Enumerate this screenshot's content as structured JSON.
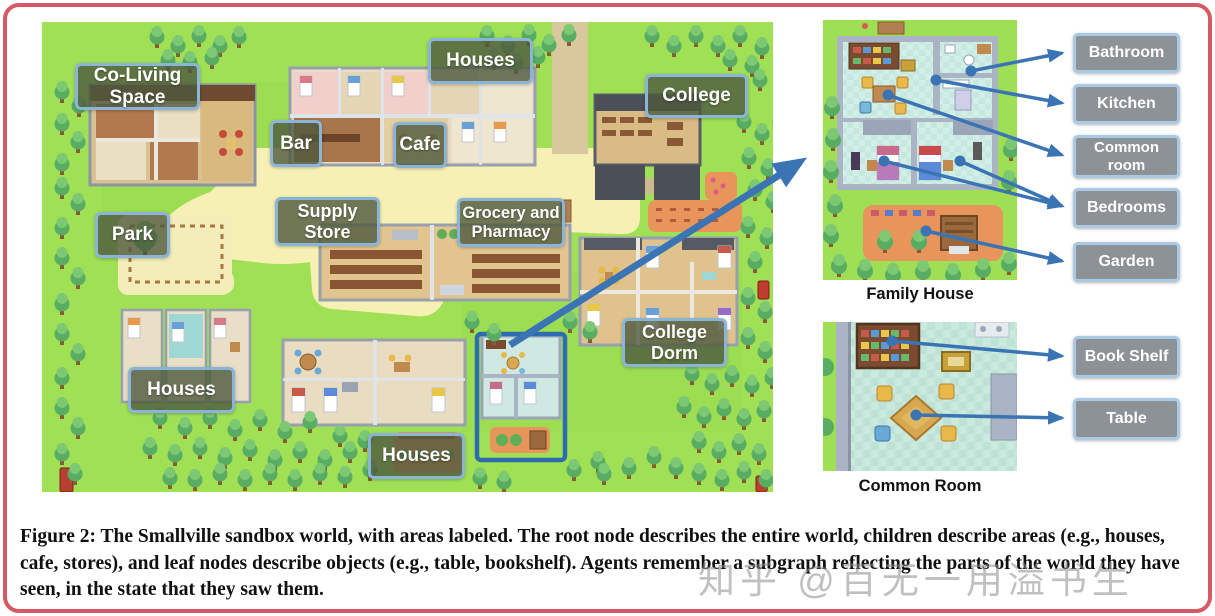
{
  "map": {
    "area_labels": [
      {
        "id": "co-living-space",
        "text": "Co-Living Space"
      },
      {
        "id": "houses-top",
        "text": "Houses"
      },
      {
        "id": "college",
        "text": "College"
      },
      {
        "id": "bar",
        "text": "Bar"
      },
      {
        "id": "cafe",
        "text": "Cafe"
      },
      {
        "id": "supply-store",
        "text": "Supply Store"
      },
      {
        "id": "grocery-pharmacy",
        "text": "Grocery and Pharmacy"
      },
      {
        "id": "park",
        "text": "Park"
      },
      {
        "id": "college-dorm",
        "text": "College Dorm"
      },
      {
        "id": "houses-bottom-left",
        "text": "Houses"
      },
      {
        "id": "houses-bottom-middle",
        "text": "Houses"
      }
    ]
  },
  "panels": {
    "family_house": {
      "caption": "Family House",
      "labels": [
        "Bathroom",
        "Kitchen",
        "Common room",
        "Bedrooms",
        "Garden"
      ]
    },
    "common_room": {
      "caption": "Common Room",
      "labels": [
        "Book Shelf",
        "Table"
      ]
    }
  },
  "figure": {
    "prefix": "Figure 2:",
    "body": "The Smallville sandbox world, with areas labeled. The root node describes the entire world, children describe areas (e.g., houses, cafe, stores), and leaf nodes describe objects (e.g., table, bookshelf). Agents remember a subgraph reflecting the parts of the world they have seen, in the state that they saw them."
  },
  "watermark": {
    "text": "知乎 @百无一用溢书生"
  },
  "colors": {
    "arrow_blue": "#3a74b4",
    "map_label_bg": "#4d593d",
    "panel_label_bg": "#8d9297",
    "label_border": "#a9c9e4",
    "frame_red": "#d65964",
    "highlight_box_blue": "#2e6cb0",
    "grass_green": "#a0e055",
    "path_cream": "#f6f0b4"
  }
}
